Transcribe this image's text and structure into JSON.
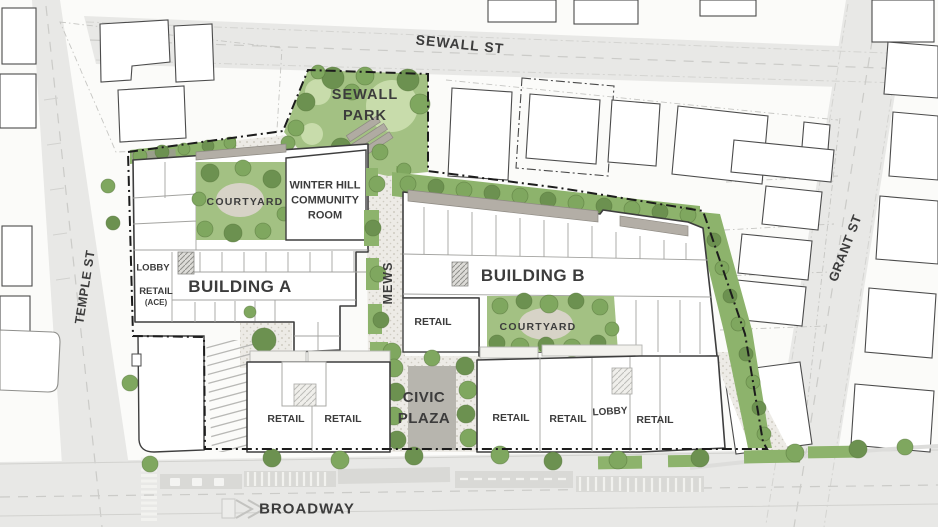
{
  "streets": {
    "sewall": "SEWALL ST",
    "temple": "TEMPLE ST",
    "grant": "GRANT ST",
    "broadway": "BROADWAY"
  },
  "site": {
    "park_lines": [
      "SEWALL",
      "PARK"
    ],
    "community_room_lines": [
      "WINTER HILL",
      "COMMUNITY",
      "ROOM"
    ],
    "courtyard_a": "COURTYARD",
    "courtyard_b": "COURTYARD",
    "building_a": "BUILDING A",
    "building_b": "BUILDING B",
    "mews": "MEWS",
    "civic_plaza_lines": [
      "CIVIC",
      "PLAZA"
    ],
    "lobby_a": "LOBBY",
    "lobby_b": "LOBBY",
    "retail_ace_lines": [
      "RETAIL",
      "(ACE)"
    ],
    "retail_mews": "RETAIL",
    "retail_sw_1": "RETAIL",
    "retail_sw_2": "RETAIL",
    "retail_se_1": "RETAIL",
    "retail_se_2": "RETAIL",
    "retail_se_3": "RETAIL"
  },
  "colors": {
    "street_gray": "#e8e8e6",
    "paving": "#edebe6",
    "paving_dot": "#cfccc2",
    "green_base": "#a3c183",
    "green_band": "#8db36c",
    "tree_green": "#7fa75f",
    "tree_dark": "#6c9150",
    "terrace_gray": "#b3aea6",
    "line_dark": "#3e3e3e",
    "boundary": "#1c1c1c",
    "label": "#3c3c3c",
    "page_bg": "#fbfbf9"
  }
}
